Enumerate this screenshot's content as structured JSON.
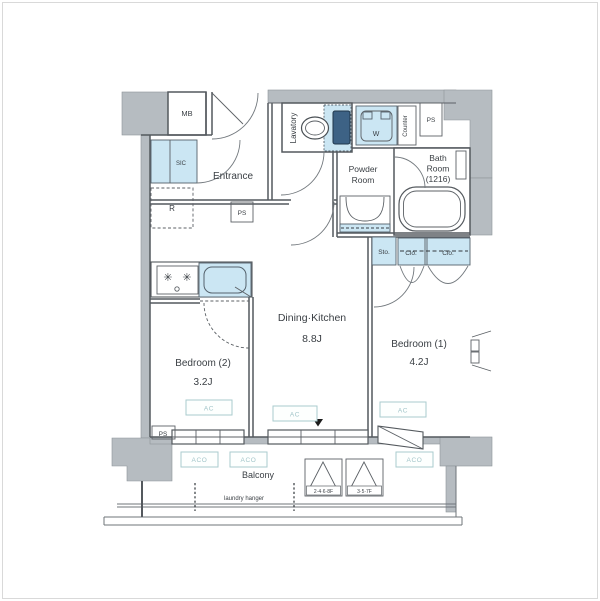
{
  "floorplan": {
    "labels": {
      "mb": "MB",
      "sic": "SIC",
      "refrigerator": "R",
      "entrance": "Entrance",
      "ps": "PS",
      "lavatory": "Lavatory",
      "washer": "W",
      "counter": "Counter",
      "bath_line1": "Bath",
      "bath_line2": "Room",
      "bath_line3": "(1216)",
      "powder_line1": "Powder",
      "powder_line2": "Room",
      "storage": "Sto.",
      "closet": "Clo.",
      "dk_name": "Dining·Kitchen",
      "dk_size": "8.8J",
      "bedroom2_name": "Bedroom (2)",
      "bedroom2_size": "3.2J",
      "bedroom1_name": "Bedroom (1)",
      "bedroom1_size": "4.2J",
      "balcony": "Balcony",
      "laundry_hanger": "laundry hanger",
      "ac": "AC",
      "aco": "ACO",
      "floors_even": "2·4·6·8F",
      "floors_odd": "3·5·7F"
    },
    "icons": {
      "burner_glyph": "✳"
    },
    "colors": {
      "wall_gray": "#b6bcc1",
      "water_blue": "#cbe6f3",
      "ac_accent": "#a2c5c9",
      "line": "#54595e"
    }
  }
}
